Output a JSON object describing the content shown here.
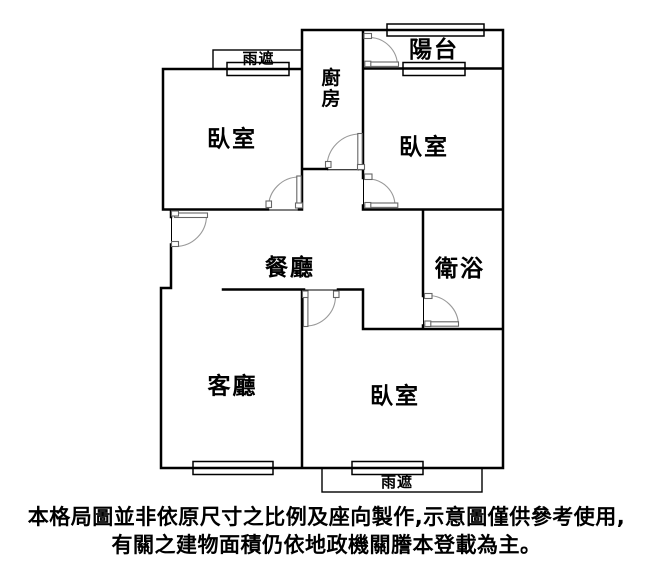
{
  "floor_plan": {
    "rooms": {
      "bedroom_top_left": "臥室",
      "kitchen": "廚房",
      "balcony": "陽台",
      "bedroom_top_right": "臥室",
      "dining_room": "餐廳",
      "bathroom": "衛浴",
      "living_room": "客廳",
      "bedroom_bottom_right": "臥室"
    },
    "canopy_top": "雨遮",
    "canopy_bottom": "雨遮"
  },
  "disclaimer": {
    "line1": "本格局圖並非依原尺寸之比例及座向製作,示意圖僅供參考使用,",
    "line2": "有關之建物面積仍依地政機關謄本登載為主。"
  },
  "colors": {
    "background": "#ffffff",
    "wall": "#000000",
    "door_swing": "#999999",
    "door_frame": "#666666",
    "text": "#000000"
  }
}
